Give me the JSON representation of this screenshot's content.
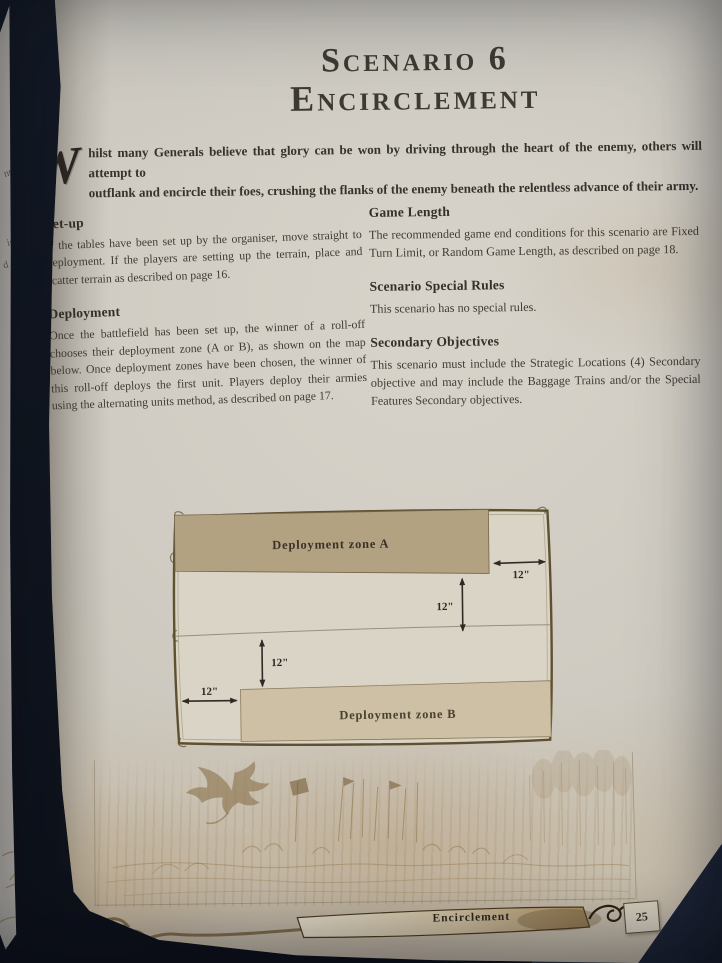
{
  "book_page": {
    "title": {
      "line1": "Scenario 6",
      "line2": "Encirclement"
    },
    "intro": {
      "dropcap": "W",
      "line1": "hilst many Generals believe that glory can be won by driving through the heart of the enemy, others will attempt to",
      "line2": "outflank and encircle their foes, crushing the flanks of the enemy beneath the relentless advance of their army."
    },
    "sections": {
      "left": [
        {
          "heading": "Set-up",
          "body": "If the tables have been set up by the organiser, move straight to deployment. If the players are setting up the terrain, place and scatter terrain as described on page 16."
        },
        {
          "heading": "Deployment",
          "body": "Once the battlefield has been set up, the winner of a roll-off chooses their deployment zone (A or B), as shown on the map below. Once deployment zones have been chosen, the winner of this roll-off deploys the first unit. Players deploy their armies using the alternating units method, as described on page 17."
        }
      ],
      "right": [
        {
          "heading": "Game Length",
          "body": "The recommended game end conditions for this scenario are Fixed Turn Limit, or Random Game Length, as described on page 18."
        },
        {
          "heading": "Scenario Special Rules",
          "body": "This scenario has no special rules."
        },
        {
          "heading": "Secondary Objectives",
          "body": "This scenario must include the Strategic Locations (4) Secondary objective and may include the Baggage Trains and/or the Special Features Secondary objectives."
        }
      ]
    },
    "map": {
      "zone_a_label": "Deployment zone A",
      "zone_b_label": "Deployment zone B",
      "dim_right": "12\"",
      "dim_upper": "12\"",
      "dim_lower": "12\"",
      "dim_left": "12\""
    },
    "footer": {
      "banner_label": "Encirclement",
      "page_number": "25"
    },
    "facing_page_fragments": {
      "f1": "nt",
      "f2": "io",
      "f3": "d on",
      "f4": "Secondary",
      "f5": "or the Baggage"
    },
    "palette": {
      "background": "#141a26",
      "paper": "#d3cec5",
      "ink": "#3b3630",
      "zone_a": "#b2a281",
      "zone_b": "#cdc0a5",
      "map_frame": "#5f5030",
      "sepia": "#8a6c3f"
    }
  }
}
